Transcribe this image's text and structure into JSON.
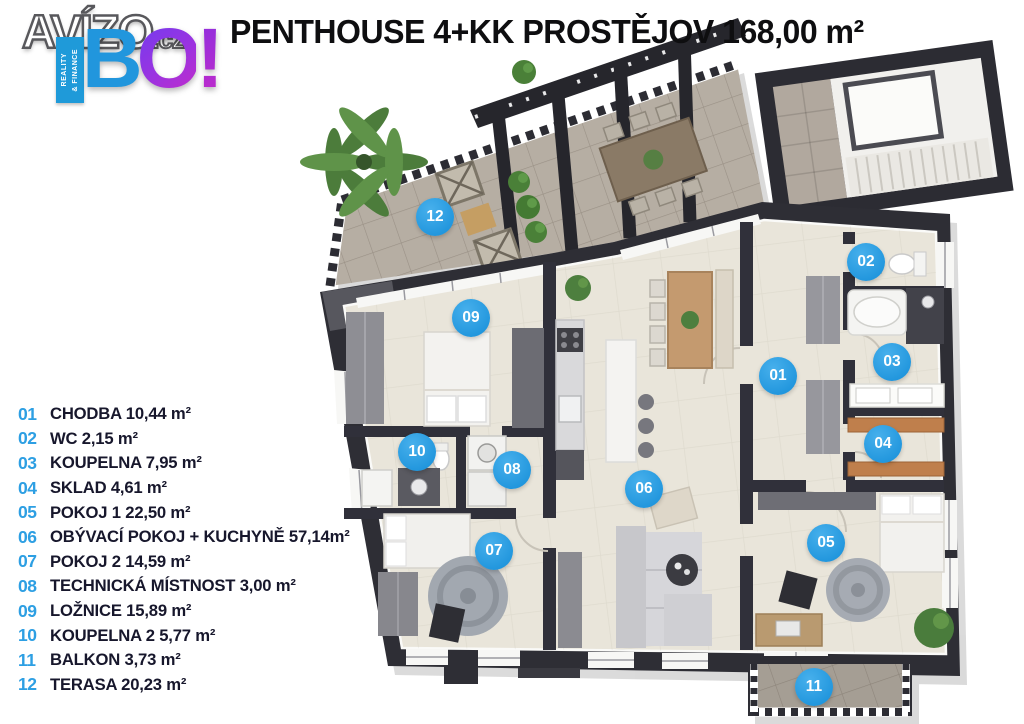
{
  "logo": {
    "brand": "AVÍZO",
    "tld": ".cz",
    "bo_b": "B",
    "bo_o": "O",
    "bo_excl": "!",
    "ribbon_line1": "REALITY",
    "ribbon_line2": "& FINANCE"
  },
  "title": "PENTHOUSE 4+KK PROSTĚJOV 168,00 m²",
  "legend": {
    "items": [
      {
        "num": "01",
        "label": "CHODBA 10,44 m²"
      },
      {
        "num": "02",
        "label": "WC 2,15 m²"
      },
      {
        "num": "03",
        "label": "KOUPELNA 7,95 m²"
      },
      {
        "num": "04",
        "label": "SKLAD 4,61 m²"
      },
      {
        "num": "05",
        "label": "POKOJ 1 22,50 m²"
      },
      {
        "num": "06",
        "label": "OBÝVACÍ POKOJ + KUCHYNĚ 57,14m²"
      },
      {
        "num": "07",
        "label": "POKOJ 2 14,59 m²"
      },
      {
        "num": "08",
        "label": "TECHNICKÁ MÍSTNOST 3,00 m²"
      },
      {
        "num": "09",
        "label": "LOŽNICE 15,89 m²"
      },
      {
        "num": "10",
        "label": "KOUPELNA 2 5,77 m²"
      },
      {
        "num": "11",
        "label": "BALKON 3,73 m²"
      },
      {
        "num": "12",
        "label": "TERASA 20,23 m²"
      }
    ]
  },
  "floorplan": {
    "markers": [
      {
        "num": "01",
        "x": 778,
        "y": 376
      },
      {
        "num": "02",
        "x": 866,
        "y": 262
      },
      {
        "num": "03",
        "x": 892,
        "y": 362
      },
      {
        "num": "04",
        "x": 883,
        "y": 444
      },
      {
        "num": "05",
        "x": 826,
        "y": 543
      },
      {
        "num": "06",
        "x": 644,
        "y": 489
      },
      {
        "num": "07",
        "x": 494,
        "y": 551
      },
      {
        "num": "08",
        "x": 512,
        "y": 470
      },
      {
        "num": "09",
        "x": 471,
        "y": 318
      },
      {
        "num": "10",
        "x": 417,
        "y": 452
      },
      {
        "num": "11",
        "x": 814,
        "y": 687
      },
      {
        "num": "12",
        "x": 435,
        "y": 217
      }
    ]
  },
  "colors": {
    "accent_blue": "#2aa0e4",
    "legend_text": "#17172c",
    "wall": "#2e2e35",
    "floor": "#e9e5da",
    "terrace_floor": "#b6aea3"
  }
}
